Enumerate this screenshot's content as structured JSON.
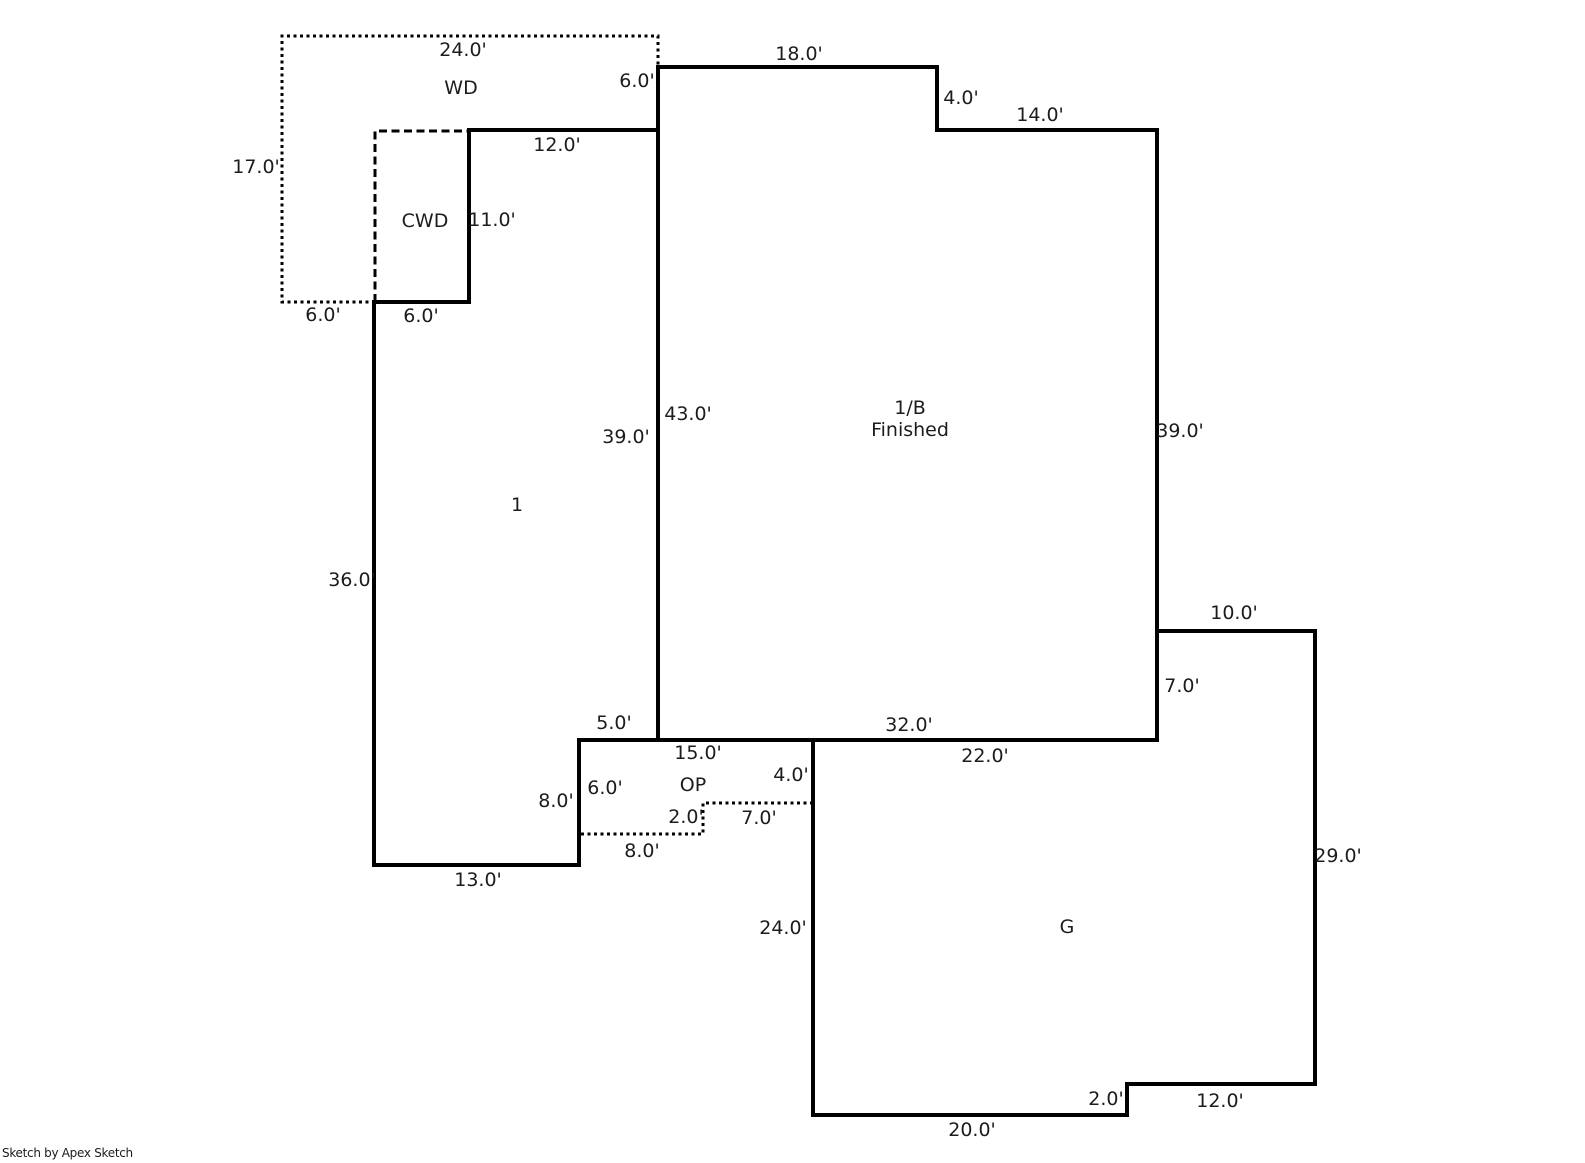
{
  "page": {
    "background": "#ffffff",
    "line_color": "#000000",
    "text_color": "#1c1c1c"
  },
  "credit": "Sketch by Apex Sketch",
  "areas": {
    "wd": {
      "label": "WD"
    },
    "cwd": {
      "label": "CWD"
    },
    "first_floor": {
      "label": "1"
    },
    "first_floor_basement": {
      "label": "1/B",
      "sublabel": "Finished"
    },
    "open_porch": {
      "label": "OP"
    },
    "garage": {
      "label": "G"
    }
  },
  "dimensions": {
    "wd_top": "24.0'",
    "wd_left": "17.0'",
    "wd_right": "6.0'",
    "wd_bottom": "6.0'",
    "cwd_right": "11.0'",
    "cwd_bottom": "6.0'",
    "first_top": "12.0'",
    "first_left": "36.0'",
    "first_right": "39.0'",
    "first_bottom": "13.0'",
    "first_bottom_step": "5.0'",
    "first_lower_right": "8.0'",
    "bsmt_top_left": "18.0'",
    "bsmt_top_step": "4.0'",
    "bsmt_top_right": "14.0'",
    "bsmt_left": "43.0'",
    "bsmt_right": "39.0'",
    "bsmt_bottom": "32.0'",
    "op_top": "15.0'",
    "op_right": "4.0'",
    "op_left": "6.0'",
    "op_inner_width": "7.0'",
    "op_inner_height": "2.0'",
    "op_bottom": "8.0'",
    "g_top": "10.0'",
    "g_shared_wall": "7.0'",
    "g_attach_bottom": "22.0'",
    "g_right": "29.0'",
    "g_left": "24.0'",
    "g_bottom_step": "2.0'",
    "g_bottom_right": "12.0'",
    "g_bottom": "20.0'"
  }
}
